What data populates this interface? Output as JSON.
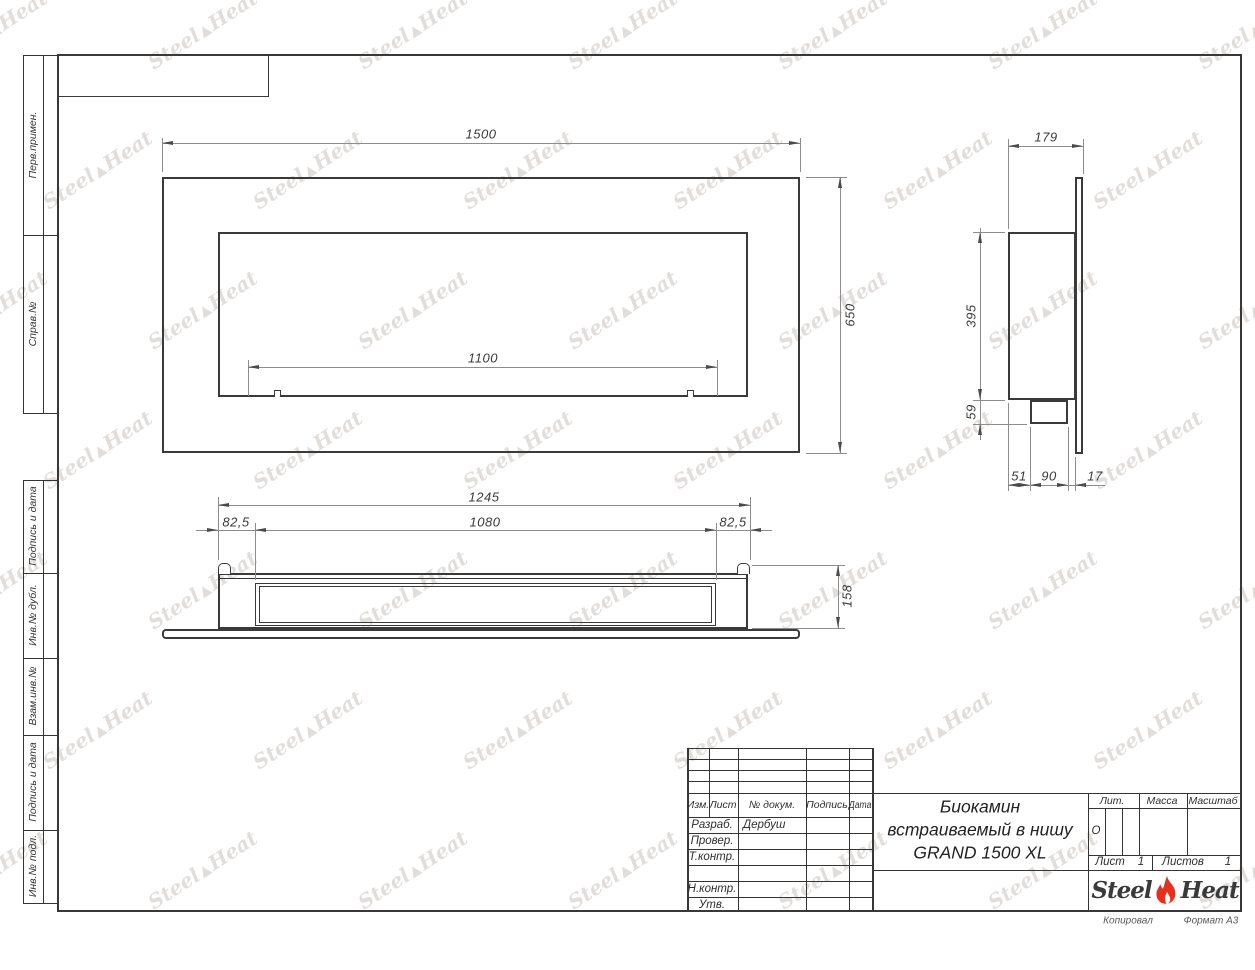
{
  "document": {
    "kind": "Чертёж (инженерный чертеж, ГОСТ)"
  },
  "margin_labels": [
    "Перв.примен.",
    "Справ.№",
    "Подпись и дата",
    "Инв.№ дубл.",
    "Взам.инв.№",
    "Подпись и дата",
    "Инв.№ подл."
  ],
  "dims": {
    "front_width": "1500",
    "front_height": "650",
    "front_burner": "1100",
    "side_depth": "179",
    "side_body_height": "395",
    "side_tray_height": "59",
    "side_bottom_1": "51",
    "side_bottom_2": "90",
    "side_bottom_3": "17",
    "bottom_total": "1245",
    "bottom_margin_left": "82,5",
    "bottom_slot": "1080",
    "bottom_margin_right": "82,5",
    "bottom_depth": "158"
  },
  "title_block": {
    "columns": [
      "Изм.",
      "Лист",
      "№ докум.",
      "Подпись",
      "Дата"
    ],
    "rows": [
      [
        "Разраб.",
        "Дербуш"
      ],
      [
        "Провер.",
        ""
      ],
      [
        "Т.контр.",
        ""
      ],
      [
        "Н.контр.",
        ""
      ],
      [
        "Утв.",
        ""
      ]
    ],
    "title_line1": "Биокамин",
    "title_line2": "встраиваемый в нишу",
    "title_line3": "GRAND 1500 XL",
    "lit_header": "Лит.",
    "lit_value": "О",
    "mass_header": "Масса",
    "scale_header": "Масштаб",
    "sheet_label": "Лист",
    "sheet_value": "1",
    "sheets_label": "Листов",
    "sheets_value": "1",
    "logo_left": "Steel",
    "logo_right": "Heat",
    "footer_copied": "Копировал",
    "footer_format": "Формат А3"
  },
  "watermark": {
    "left": "Steel",
    "right": "Heat"
  },
  "colors": {
    "line": "#3a3a3a",
    "dim_line": "#8d8d8d",
    "text": "#333333",
    "logo_red": "#e4301c",
    "watermark": "rgba(168,156,148,0.34)"
  }
}
